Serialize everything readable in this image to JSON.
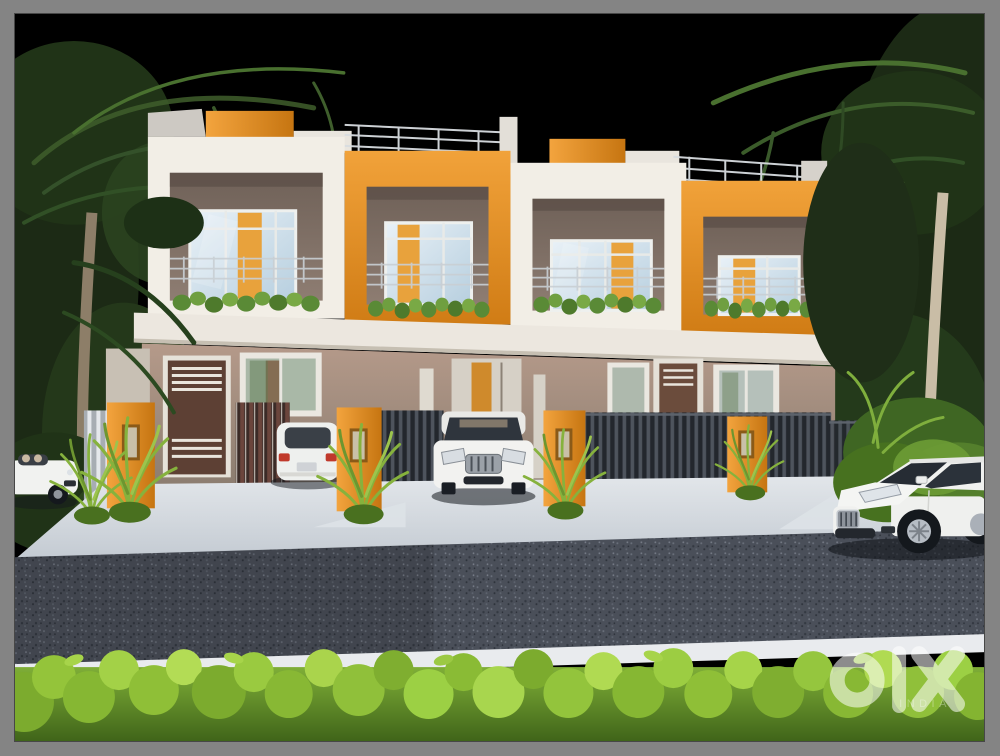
{
  "meta": {
    "kind": "marketplace-listing-photo",
    "width": 1000,
    "height": 756
  },
  "watermark": {
    "brand": "OLX",
    "country_label": "INDIA"
  },
  "scene": {
    "setting": "night exterior, 3D architectural render",
    "subject": "two-storey row houses with alternating white and orange balcony bays",
    "building": {
      "storeys": 2,
      "balcony_bays": [
        "white",
        "orange",
        "white",
        "orange"
      ],
      "features": [
        "roof railings",
        "orange parapet blocks",
        "glass balcony doors",
        "balcony planters",
        "vertical slat fences",
        "orange gate pillars",
        "brown entry doors",
        "ground-floor windows"
      ]
    },
    "vehicles": [
      {
        "name": "white convertible",
        "position": "far left driveway"
      },
      {
        "name": "white hatchback rear view",
        "position": "left gate"
      },
      {
        "name": "white sedan front view",
        "position": "center driveway"
      },
      {
        "name": "white sedan driving",
        "position": "road lower right"
      }
    ],
    "foreground": [
      "asphalt road",
      "white curb",
      "bright green hedge"
    ],
    "backdrop": [
      "black sky",
      "palm trees left",
      "palm trees right"
    ]
  },
  "palette": {
    "frame": "#848484",
    "sky": "#000000",
    "orange": "#e08a20",
    "facade_white": "#f2eee6",
    "ground_wall": "#9b8a79",
    "fence_dark": "#3c4149",
    "driveway": "#ccd2d9",
    "road": "#4a4f59",
    "curb": "#e9ebee",
    "hedge_green": "#8fbf37",
    "palm_green": "#24381a",
    "car_white": "#f2f2f0",
    "watermark": "#ffffff"
  }
}
